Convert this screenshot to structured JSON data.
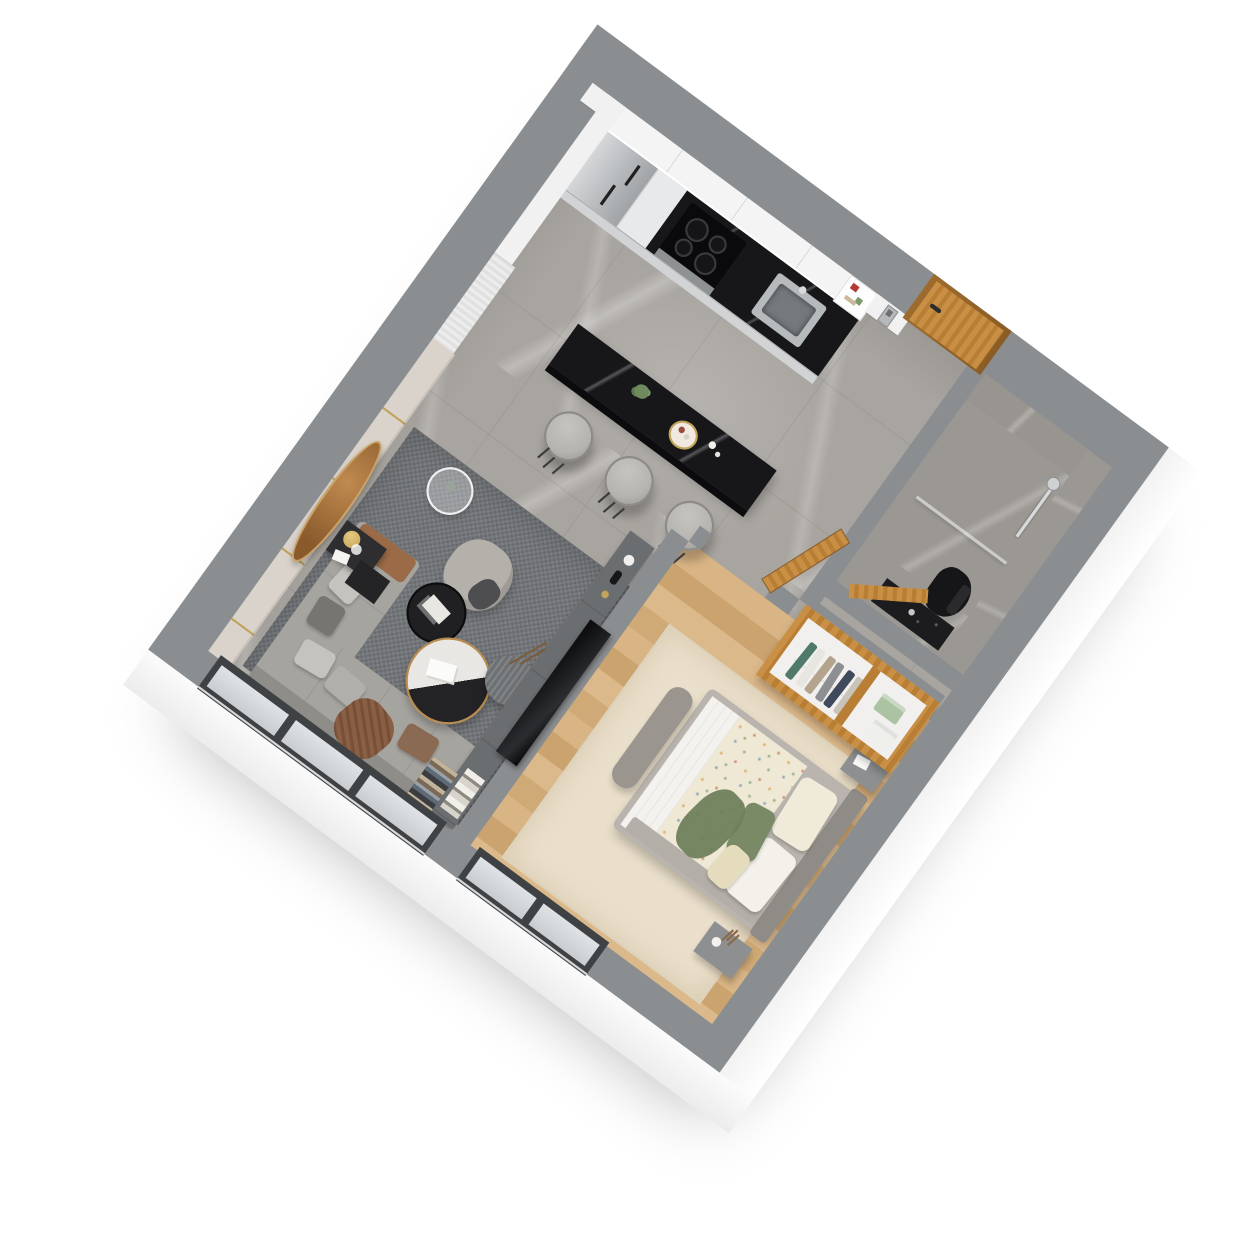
{
  "scene": {
    "kind": "3d-isometric-floorplan-render",
    "description": "Photoreal axonometric render of a one-bedroom apartment floor plan on a white background with soft drop shadow",
    "background": "#ffffff",
    "visible_text": []
  },
  "palette": {
    "wall_top": "#8b8e91",
    "wall_outer": "#fafafa",
    "wall_inner": "#f1f1f2",
    "marble": "#a8a49f",
    "marble_dark": "#9b9792",
    "wood": "#d5b081",
    "oak": "#c08a42",
    "oak_dark": "#9c6b2d",
    "black_marble": "#17171a",
    "steel": "#b7babc",
    "white_cab": "#f4f4f5",
    "sofa": "#a6a49f",
    "sofa_dark": "#8f8d88",
    "rug": "#73767a",
    "rug_bed": "#eadfca",
    "duvet": "#eee8d4",
    "pillow_green": "#7a8a66",
    "bronze": "#a9743c",
    "gold": "#c2a35c",
    "console": "#6b6e71",
    "wood_trim": "#b98c5a",
    "tv": "#0d0e10",
    "winframe": "#3f4245",
    "glass": "#dfe3e5",
    "throw": "#8b5f43",
    "stool": "#b6b4af",
    "toilet": "#161618",
    "panel": "#d9d3cb"
  },
  "rooms": {
    "kitchen": {
      "floor": "gray marble tiles",
      "items": [
        "stainless refrigerator",
        "white upper cabinets",
        "open shelf with red and green accessories",
        "black marble counter",
        "induction cooktop with 4 burners",
        "steel oven band",
        "steel sink with faucet",
        "black marble breakfast island",
        "serving tray with fruit",
        "small plant",
        "two cups",
        "three gray upholstered bar stools with black legs"
      ]
    },
    "entry": {
      "items": [
        "oak entry door with dark handle",
        "wall intercom panel"
      ]
    },
    "bathroom": {
      "floor": "dark gray marble",
      "walls": "gray marble cladding",
      "items": [
        "chrome shower bar and hand shower",
        "glass divider",
        "black toilet",
        "black speckled vanity with faucet",
        "open oak door"
      ]
    },
    "wardrobe": {
      "items": [
        "open oak wardrobe",
        "hanging clothes in teal, white, tan, gray, navy",
        "folded green shirt stack",
        "folded white shirt stack"
      ]
    },
    "bedroom": {
      "floor": "light oak planks",
      "items": [
        "cream area rug",
        "double bed with gray frame",
        "gray headboard against outer wall",
        "floral duvet with white foot sheet and gray blanket",
        "two beige pillows",
        "green accent pillow",
        "small floral pillow",
        "green throw",
        "gray upholstered bench",
        "nightstand with tissue box",
        "nightstand with vase and dried flowers",
        "open oak bedroom door",
        "window on lower wall"
      ]
    },
    "living": {
      "floor": "gray marble with dark textured rug",
      "items": [
        "beige paneled feature wall with gold trim",
        "bronze oval wall mirror",
        "sheer white curtain panel",
        "L-shaped gray sectional sofa",
        "cognac leather back section",
        "gray and brown throw pillows",
        "brown knit throw",
        "gray armchair with dark throw",
        "round glass side table",
        "black side tables with gold table lamp",
        "two-tone round coffee table white marble and black with gold rim",
        "black round side table with magazines",
        "gray herringbone pouf with decorative branch",
        "TV media partition with dark console and wood trim",
        "wall mounted TV",
        "decor vases and ball",
        "book stacks",
        "dark floor shelf with books",
        "two large windows on lower wall"
      ]
    },
    "structure": {
      "exterior_wall_top_color": "#8b8e91",
      "exterior_wall_outer_color": "#ffffff",
      "windows": 3,
      "doors": 4,
      "stools": 3
    }
  }
}
